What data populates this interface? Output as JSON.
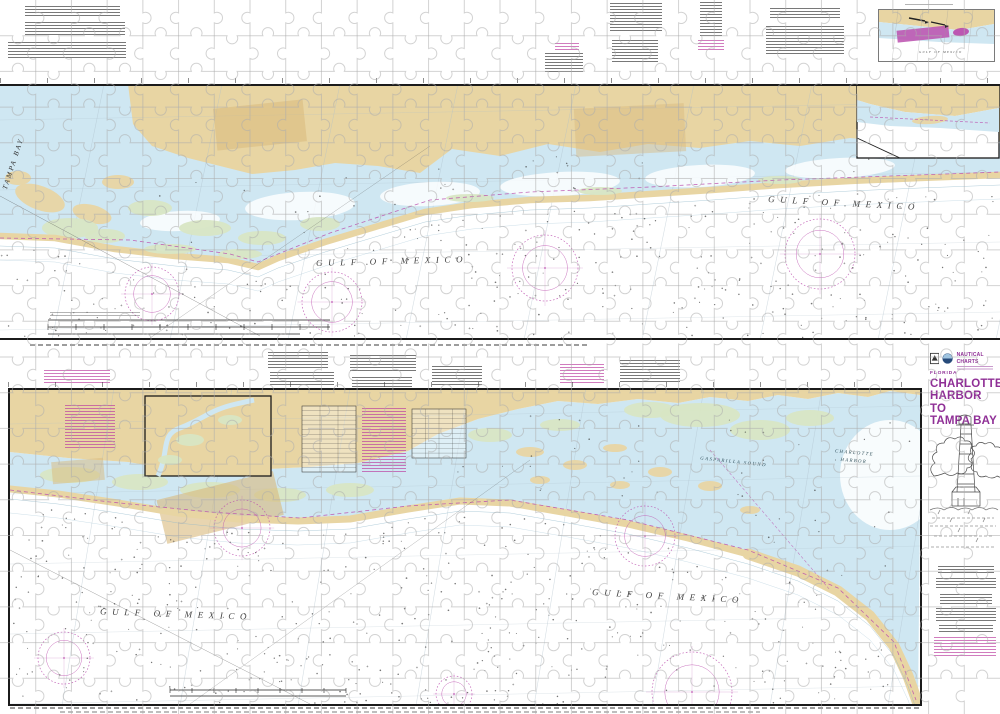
{
  "sea_labels": {
    "gulf_of_mexico": "GULF OF MEXICO",
    "tampa_bay": "TAMPA BAY",
    "gasparilla_sound": "GASPARILLA SOUND",
    "charlotte_line1": "CHARLOTTE",
    "charlotte_line2": "HARBOR"
  },
  "title_block": {
    "brand": "NAUTICAL CHARTS",
    "state": "FLORIDA",
    "title_line1": "CHARLOTTE",
    "title_line2": "HARBOR TO",
    "title_line3": "TAMPA BAY"
  },
  "colors": {
    "land_tan": "#e8d5a3",
    "shallow_blue": "#cfe7f2",
    "marsh_green": "#d8e6c4",
    "chart_magenta": "#bb4fae",
    "title_purple": "#8f2f96",
    "contour_blue": "#90b8cb",
    "puzzle_line": "#adadad",
    "border_black": "#1b1b1b"
  }
}
